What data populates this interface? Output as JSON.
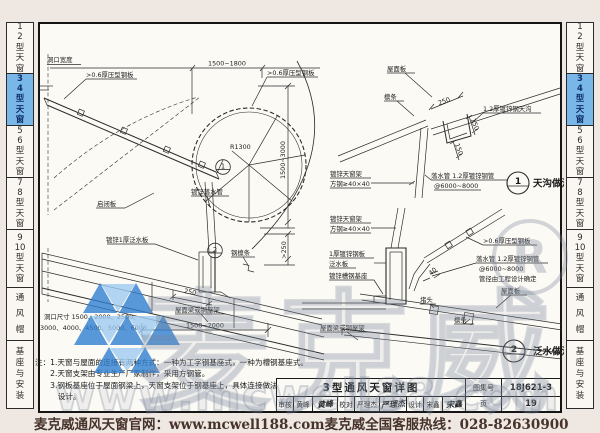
{
  "sidebar": {
    "tabs": [
      {
        "label": "1\n2\n型\n天\n窗",
        "active": false
      },
      {
        "label": "3\n4\n型\n天\n窗",
        "active": true
      },
      {
        "label": "5\n6\n型\n天\n窗",
        "active": false
      },
      {
        "label": "7\n8\n型\n天\n窗",
        "active": false
      },
      {
        "label": "9\n10\n型\n天\n窗",
        "active": false
      },
      {
        "label": "通\n风\n帽",
        "active": false
      },
      {
        "label": "基\n座\n与\n安\n装",
        "active": false
      }
    ]
  },
  "drawing": {
    "labels": {
      "width": "洞口宽度",
      "sheet1": ">0.6厚压型钢板",
      "sheet2": ">0.6厚压型钢板",
      "sheet3": ">0.6厚压型钢板",
      "qibiban": "启闭板",
      "downpipe": "镀锌落水管",
      "flash1": "镀锌1厚泛水板",
      "steel_purlin": "钢檩条",
      "beam": "屋面梁或钢屋架",
      "roof_panel": "屋面板",
      "purlin": "檩条",
      "gutter": "1.2厚镀锌钢天沟",
      "frame_a": "镀锌天窗架",
      "frame_b": "方钢≥40×40",
      "pipe_a": "落水管 1.2厚镀锌钢管",
      "pipe_b": "@6000~8000",
      "pipe_c": "管径由工程设计确定",
      "flash2_a": "1厚镀锌钢板",
      "flash2_b": "泛水板",
      "base2": "镀锌槽钢基座",
      "plug": "堵头"
    },
    "dims": {
      "top": "1500~1800",
      "r1300": "R1300",
      "h1": "1500~3000",
      "h2": ">250",
      "d250": "250",
      "span": "1500~2000",
      "d150": "150",
      "d40": "40",
      "opening1": "洞口尺寸 1500、2000、2500、",
      "opening2": "3000、4000、4500、5000、6000"
    },
    "marks": {
      "m1": "1",
      "m2": "2",
      "d1_title": "天沟做法",
      "d2_title": "泛水做法"
    },
    "notes": "注：1.天窗与屋面的连接有两种方式：一种为工字钢基座式，一种为槽钢基座式。\n　　2.天窗支架由专业生产厂家制作，采用方钢管。\n　　3.钢板基座位于屋面钢梁上，天窗支架位于钢基座上，具体连接做法按工程\n　　　设计。"
  },
  "title_block": {
    "title": "3型通风天窗详图",
    "atlas_no_label": "图集号",
    "atlas_no": "18J621-3",
    "page_label": "页",
    "page": "19",
    "reviewer_label": "审核",
    "reviewer": "黄峰",
    "reviewer_sig": "黄峰",
    "checker_label": "校对",
    "checker": "严理杰",
    "checker_sig": "严理杰",
    "designer_label": "设计",
    "designer": "宋鑫",
    "designer_sig": "宋鑫"
  },
  "footer": {
    "left": "麦克威通风天窗官网：www.mcwell188.com",
    "right": "麦克威全国客服热线：028-82630900"
  },
  "watermark": {
    "brand": "麦克威",
    "url": "www.mcwell88.com",
    "registered": "R"
  },
  "colors": {
    "active_tab_bg": "#79b7e8",
    "line": "#2b2b2b",
    "footer_text": "#46332b",
    "logo_blue": "#2e7fd1",
    "logo_blue_light": "#9ccaf0"
  }
}
